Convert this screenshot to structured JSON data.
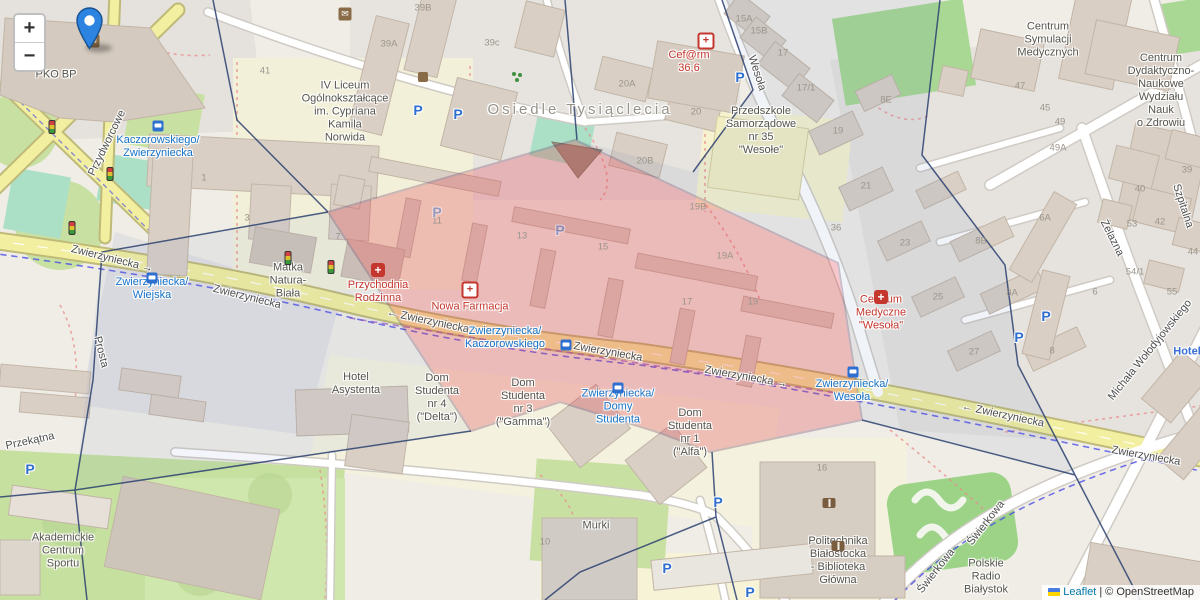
{
  "controls": {
    "zoom_in": "+",
    "zoom_out": "−"
  },
  "attribution": {
    "leaflet": "Leaflet",
    "separator": "|",
    "osm": "© OpenStreetMap"
  },
  "colors": {
    "selection_fill": "#e23c4b",
    "selection_border": "#5b2a55",
    "cell_border": "#2c4170",
    "road_yellow": "#f2efa0",
    "transit_blue": "#1673c8",
    "medical_red": "#c4372e",
    "hotel_blue": "#3a6fd8",
    "link_blue": "#0078A8",
    "marker_blue": "#2d84e0",
    "flag_top": "#4C7BE1",
    "flag_bottom": "#FFD500"
  },
  "icon_glyphs": {
    "parking": "P",
    "post": "✉",
    "pharmacy": "+",
    "hospital": "+"
  },
  "labels": {
    "streets": [
      {
        "text": "Przydworcowe",
        "x": 107,
        "y": 143,
        "rot": -64
      },
      {
        "text": "Zwierzyniecka →",
        "x": 112,
        "y": 259,
        "rot": 14
      },
      {
        "text": "Zwierzyniecka",
        "x": 247,
        "y": 297,
        "rot": 14
      },
      {
        "text": "← Zwierzyniecka",
        "x": 428,
        "y": 321,
        "rot": 12
      },
      {
        "text": "Zwierzyniecka",
        "x": 608,
        "y": 352,
        "rot": 10
      },
      {
        "text": "Zwierzyniecka →",
        "x": 746,
        "y": 377,
        "rot": 10
      },
      {
        "text": "← Zwierzyniecka",
        "x": 1003,
        "y": 415,
        "rot": 12
      },
      {
        "text": "Zwierzyniecka",
        "x": 1146,
        "y": 456,
        "rot": 10
      },
      {
        "text": "Wesoła",
        "x": 757,
        "y": 73,
        "rot": 72
      },
      {
        "text": "Prosta",
        "x": 101,
        "y": 352,
        "rot": 76
      },
      {
        "text": "Przekątna",
        "x": 30,
        "y": 441,
        "rot": -12
      },
      {
        "text": "Żelazna",
        "x": 1112,
        "y": 238,
        "rot": 63
      },
      {
        "text": "Szpitalna",
        "x": 1183,
        "y": 206,
        "rot": 72
      },
      {
        "text": "Michała Wołodyjowskiego",
        "x": 1150,
        "y": 350,
        "rot": -51
      },
      {
        "text": "Świerkowa",
        "x": 986,
        "y": 523,
        "rot": -52
      },
      {
        "text": "Świerkowa",
        "x": 936,
        "y": 571,
        "rot": -52
      }
    ],
    "places": [
      {
        "lines": [
          "Osiedle Tysiąclecia"
        ],
        "x": 580,
        "y": 110,
        "cls": "pl-area"
      },
      {
        "lines": [
          "PKO BP"
        ],
        "x": 56,
        "y": 75,
        "cls": "pl-poi"
      },
      {
        "lines": [
          "IV Liceum",
          "Ogólnokształcące",
          "im. Cypriana",
          "Kamila",
          "Norwida"
        ],
        "x": 345,
        "y": 112,
        "cls": "pl-poi"
      },
      {
        "lines": [
          "Przedszkole",
          "Samorządowe",
          "nr 35",
          "\"Wesołe\""
        ],
        "x": 761,
        "y": 131,
        "cls": "pl-poi"
      },
      {
        "lines": [
          "Centrum",
          "Symulacji",
          "Medycznych"
        ],
        "x": 1048,
        "y": 40,
        "cls": "pl-poi"
      },
      {
        "lines": [
          "Centrum",
          "Dydaktyczno-",
          "Naukowe",
          "Wydziału",
          "Nauk",
          "o Zdrowiu"
        ],
        "x": 1161,
        "y": 91,
        "cls": "pl-poi"
      },
      {
        "lines": [
          "Matka",
          "Natura-",
          "Biała"
        ],
        "x": 288,
        "y": 281,
        "cls": "pl-poi"
      },
      {
        "lines": [
          "Hotel",
          "Asystenta"
        ],
        "x": 356,
        "y": 384,
        "cls": "pl-poi"
      },
      {
        "lines": [
          "Dom",
          "Studenta",
          "nr 4",
          "(\"Delta\")"
        ],
        "x": 437,
        "y": 398,
        "cls": "pl-poi"
      },
      {
        "lines": [
          "Dom",
          "Studenta",
          "nr 3",
          "(\"Gamma\")"
        ],
        "x": 523,
        "y": 403,
        "cls": "pl-poi"
      },
      {
        "lines": [
          "Dom",
          "Studenta",
          "nr 1",
          "(\"Alfa\")"
        ],
        "x": 690,
        "y": 433,
        "cls": "pl-poi"
      },
      {
        "lines": [
          "Akademickie",
          "Centrum",
          "Sportu"
        ],
        "x": 63,
        "y": 551,
        "cls": "pl-poi"
      },
      {
        "lines": [
          "Murki"
        ],
        "x": 596,
        "y": 526,
        "cls": "pl-poi"
      },
      {
        "lines": [
          "Politechnika",
          "Białostocka",
          "- Biblioteka",
          "Główna"
        ],
        "x": 838,
        "y": 561,
        "cls": "pl-poi"
      },
      {
        "lines": [
          "Polskie",
          "Radio",
          "Białystok"
        ],
        "x": 986,
        "y": 577,
        "cls": "pl-poi"
      },
      {
        "lines": [
          "Cef@rm",
          "36,6"
        ],
        "x": 689,
        "y": 62,
        "cls": "pl-medical"
      },
      {
        "lines": [
          "Przychodnia",
          "Rodzinna"
        ],
        "x": 378,
        "y": 292,
        "cls": "pl-medical"
      },
      {
        "lines": [
          "Nowa Farmacja"
        ],
        "x": 470,
        "y": 307,
        "cls": "pl-medical"
      },
      {
        "lines": [
          "Centrum",
          "Medyczne",
          "\"Wesoła\""
        ],
        "x": 881,
        "y": 313,
        "cls": "pl-medical"
      },
      {
        "lines": [
          "Kaczorowskiego/",
          "Zwierzyniecka"
        ],
        "x": 158,
        "y": 147,
        "cls": "pl-transit"
      },
      {
        "lines": [
          "Zwierzyniecka/",
          "Wiejska"
        ],
        "x": 152,
        "y": 289,
        "cls": "pl-transit"
      },
      {
        "lines": [
          "Zwierzyniecka/",
          "Kaczorowskiego"
        ],
        "x": 505,
        "y": 338,
        "cls": "pl-transit"
      },
      {
        "lines": [
          "Zwierzyniecka/",
          "Domy",
          "Studenta"
        ],
        "x": 618,
        "y": 407,
        "cls": "pl-transit"
      },
      {
        "lines": [
          "Zwierzyniecka/",
          "Wesoła"
        ],
        "x": 852,
        "y": 391,
        "cls": "pl-transit"
      },
      {
        "lines": [
          "Hotel"
        ],
        "x": 1187,
        "y": 352,
        "cls": "pl-hotel"
      }
    ],
    "building_numbers": [
      {
        "t": "39B",
        "x": 423,
        "y": 8
      },
      {
        "t": "39A",
        "x": 389,
        "y": 44
      },
      {
        "t": "39c",
        "x": 492,
        "y": 43
      },
      {
        "t": "41",
        "x": 265,
        "y": 71
      },
      {
        "t": "20A",
        "x": 627,
        "y": 84
      },
      {
        "t": "20",
        "x": 696,
        "y": 112
      },
      {
        "t": "20B",
        "x": 645,
        "y": 161
      },
      {
        "t": "15A",
        "x": 744,
        "y": 19
      },
      {
        "t": "15B",
        "x": 759,
        "y": 31
      },
      {
        "t": "17",
        "x": 783,
        "y": 53
      },
      {
        "t": "17/1",
        "x": 806,
        "y": 88
      },
      {
        "t": "7",
        "x": 338,
        "y": 237
      },
      {
        "t": "11",
        "x": 437,
        "y": 221
      },
      {
        "t": "13",
        "x": 522,
        "y": 236
      },
      {
        "t": "15",
        "x": 603,
        "y": 247
      },
      {
        "t": "17",
        "x": 687,
        "y": 302
      },
      {
        "t": "19",
        "x": 753,
        "y": 302
      },
      {
        "t": "19A",
        "x": 725,
        "y": 256
      },
      {
        "t": "19B",
        "x": 698,
        "y": 207
      },
      {
        "t": "36",
        "x": 836,
        "y": 228
      },
      {
        "t": "19",
        "x": 838,
        "y": 131
      },
      {
        "t": "21",
        "x": 866,
        "y": 186
      },
      {
        "t": "23",
        "x": 905,
        "y": 243
      },
      {
        "t": "25",
        "x": 938,
        "y": 297
      },
      {
        "t": "27",
        "x": 974,
        "y": 352
      },
      {
        "t": "8E",
        "x": 886,
        "y": 100
      },
      {
        "t": "8B",
        "x": 981,
        "y": 241
      },
      {
        "t": "8A",
        "x": 1012,
        "y": 293
      },
      {
        "t": "8",
        "x": 1052,
        "y": 351
      },
      {
        "t": "6A",
        "x": 1045,
        "y": 218
      },
      {
        "t": "49A",
        "x": 1058,
        "y": 148
      },
      {
        "t": "47",
        "x": 1020,
        "y": 86
      },
      {
        "t": "45",
        "x": 1045,
        "y": 108
      },
      {
        "t": "49",
        "x": 1060,
        "y": 122
      },
      {
        "t": "39",
        "x": 1187,
        "y": 170
      },
      {
        "t": "40",
        "x": 1140,
        "y": 189
      },
      {
        "t": "53",
        "x": 1132,
        "y": 224
      },
      {
        "t": "42",
        "x": 1160,
        "y": 222
      },
      {
        "t": "44",
        "x": 1193,
        "y": 252
      },
      {
        "t": "54/1",
        "x": 1135,
        "y": 272
      },
      {
        "t": "55",
        "x": 1172,
        "y": 292
      },
      {
        "t": "6",
        "x": 1095,
        "y": 292
      },
      {
        "t": "16",
        "x": 822,
        "y": 468
      },
      {
        "t": "10",
        "x": 545,
        "y": 542
      },
      {
        "t": "3",
        "x": 247,
        "y": 218
      },
      {
        "t": "1",
        "x": 204,
        "y": 178
      }
    ]
  },
  "icons": [
    {
      "t": "post",
      "x": 93,
      "y": 41
    },
    {
      "t": "post",
      "x": 345,
      "y": 14
    },
    {
      "t": "shop",
      "x": 423,
      "y": 77
    },
    {
      "t": "pharmacy",
      "x": 706,
      "y": 41
    },
    {
      "t": "pharmacy",
      "x": 470,
      "y": 290
    },
    {
      "t": "hospital",
      "x": 378,
      "y": 270
    },
    {
      "t": "hospital",
      "x": 881,
      "y": 297
    },
    {
      "t": "parking",
      "x": 418,
      "y": 110
    },
    {
      "t": "parking",
      "x": 458,
      "y": 114
    },
    {
      "t": "parking",
      "x": 740,
      "y": 77
    },
    {
      "t": "parking",
      "x": 1019,
      "y": 337
    },
    {
      "t": "parking",
      "x": 1046,
      "y": 316
    },
    {
      "t": "parking",
      "x": 718,
      "y": 502
    },
    {
      "t": "parking",
      "x": 667,
      "y": 568
    },
    {
      "t": "parking",
      "x": 750,
      "y": 592
    },
    {
      "t": "parking",
      "x": 30,
      "y": 469
    },
    {
      "t": "parking",
      "x": 437,
      "y": 212,
      "o": 0.45
    },
    {
      "t": "parking",
      "x": 560,
      "y": 230,
      "o": 0.45
    },
    {
      "t": "bus",
      "x": 158,
      "y": 126
    },
    {
      "t": "bus",
      "x": 152,
      "y": 278
    },
    {
      "t": "bus",
      "x": 566,
      "y": 345
    },
    {
      "t": "bus",
      "x": 618,
      "y": 388
    },
    {
      "t": "bus",
      "x": 853,
      "y": 372
    },
    {
      "t": "traffic",
      "x": 52,
      "y": 127
    },
    {
      "t": "traffic",
      "x": 110,
      "y": 174
    },
    {
      "t": "traffic",
      "x": 72,
      "y": 228
    },
    {
      "t": "traffic",
      "x": 288,
      "y": 258
    },
    {
      "t": "traffic",
      "x": 331,
      "y": 267
    },
    {
      "t": "library",
      "x": 829,
      "y": 503
    },
    {
      "t": "library",
      "x": 838,
      "y": 536
    },
    {
      "t": "playground",
      "x": 514,
      "y": 74
    }
  ]
}
